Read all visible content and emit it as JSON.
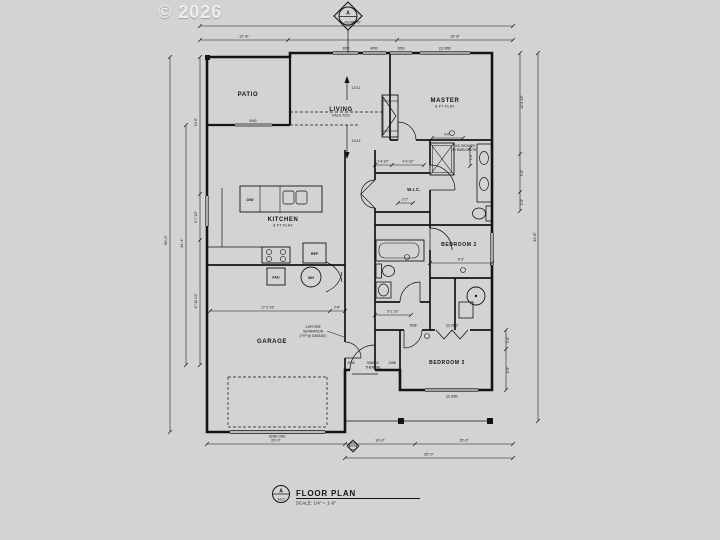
{
  "canvas": {
    "background": "#d3d3d3",
    "ink": "#141414"
  },
  "watermark": "© 2026",
  "section_marker": {
    "letter": "A",
    "sheet": "A3.0"
  },
  "title_block": {
    "marker_letter": "A",
    "marker_sheet": "A3.0",
    "title": "FLOOR PLAN",
    "scale": "SCALE: 1/4\" = 1'-0\""
  },
  "rooms": {
    "patio": {
      "name": "PATIO"
    },
    "living": {
      "name": "LIVING",
      "ceiling": "VAULTED"
    },
    "master": {
      "name": "MASTER",
      "ceiling": "8 FT FLAT"
    },
    "wic": {
      "name": "W.I.C."
    },
    "kitchen": {
      "name": "KITCHEN",
      "ceiling": "8 FT FLAT"
    },
    "bedroom2": {
      "name": "BEDROOM 2"
    },
    "garage": {
      "name": "GARAGE"
    },
    "bedroom3": {
      "name": "BEDROOM 3"
    }
  },
  "fixtures": {
    "ref": "REF",
    "dw": "D/W",
    "wh": "WH",
    "fau": "FAU"
  },
  "slopes": {
    "upper": "2.5:12",
    "lower": "3.5:12"
  },
  "notes": {
    "fire": [
      "1-HR FIRE",
      "SEPARATION",
      "(TYP @ GARAGE)"
    ],
    "entry": [
      "3068 SC",
      "THERMAL"
    ],
    "shower": [
      "TILE SHOWER",
      "W/ BARN DOOR"
    ]
  },
  "openings": {
    "patio_slider": "9060",
    "win_a": "3050",
    "win_b": "4050",
    "win_c": "2650",
    "master_window": "(2) 3050",
    "bed3_window": "(2) 3050",
    "bed3_closet": "(2) 2668",
    "bed3_door": "2668",
    "entry_left": "2068",
    "entry_right": "2068",
    "garage_ohd": "16080 OHD"
  },
  "dims": {
    "top_overall": "45'-0\"",
    "top_left": "12'-8\"",
    "top_right": "16'-8\"",
    "left_overall": "50'-0\"",
    "left_mid": "34'-4\"",
    "left_a": "19'-8\"",
    "left_b": "6'-7 1/2\"",
    "left_c": "17'-10 1/2\"",
    "right_a": "14'-6 1/2\"",
    "right_b": "5'-6\"",
    "right_c": "2'-8\"",
    "right_d": "2'-8\"",
    "right_e": "8'-8\"",
    "right_overall": "34'-8\"",
    "bottom_garage": "20'-0\"",
    "bottom_a": "10'-0\"",
    "bottom_b": "15'-0\"",
    "bottom_overall": "25'-0\"",
    "garage_w": "17'-2 1/2\"",
    "garage_w2": "2'-8\"",
    "wic_a": "2'-4 1/2\"",
    "wic_b": "4'-6 1/2\"",
    "wic_c": "2'-2\"",
    "mbath_a": "4'-6\"",
    "mbath_b": "2'-6\"",
    "bed2_a": "9'-2\"",
    "bath2_a": "5'-1 1/2\""
  }
}
